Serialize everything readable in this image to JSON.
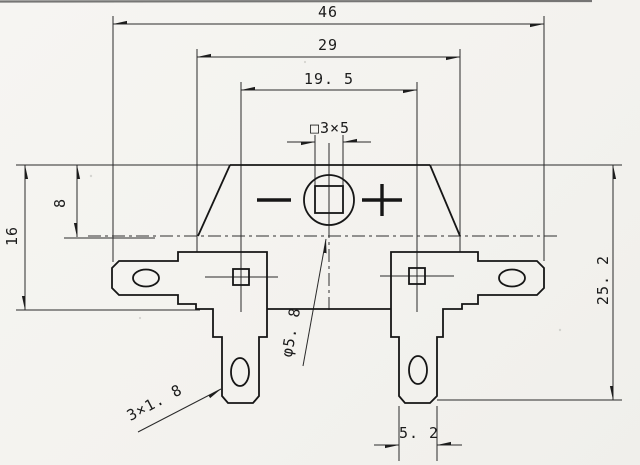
{
  "drawing": {
    "kind": "engineering-dimension-drawing",
    "colors": {
      "line": "#1b1b1b",
      "paper": "#f5f4f1"
    }
  },
  "labels": {
    "dim_46": "46",
    "dim_29": "29",
    "dim_19_5": "19. 5",
    "square_hole": "□3×5",
    "dim_8": "8",
    "dim_16": "16",
    "dim_25_2": "25. 2",
    "dim_5_2": "5. 2",
    "hole_dia": "φ5. 8",
    "slot": "3×1. 8"
  }
}
